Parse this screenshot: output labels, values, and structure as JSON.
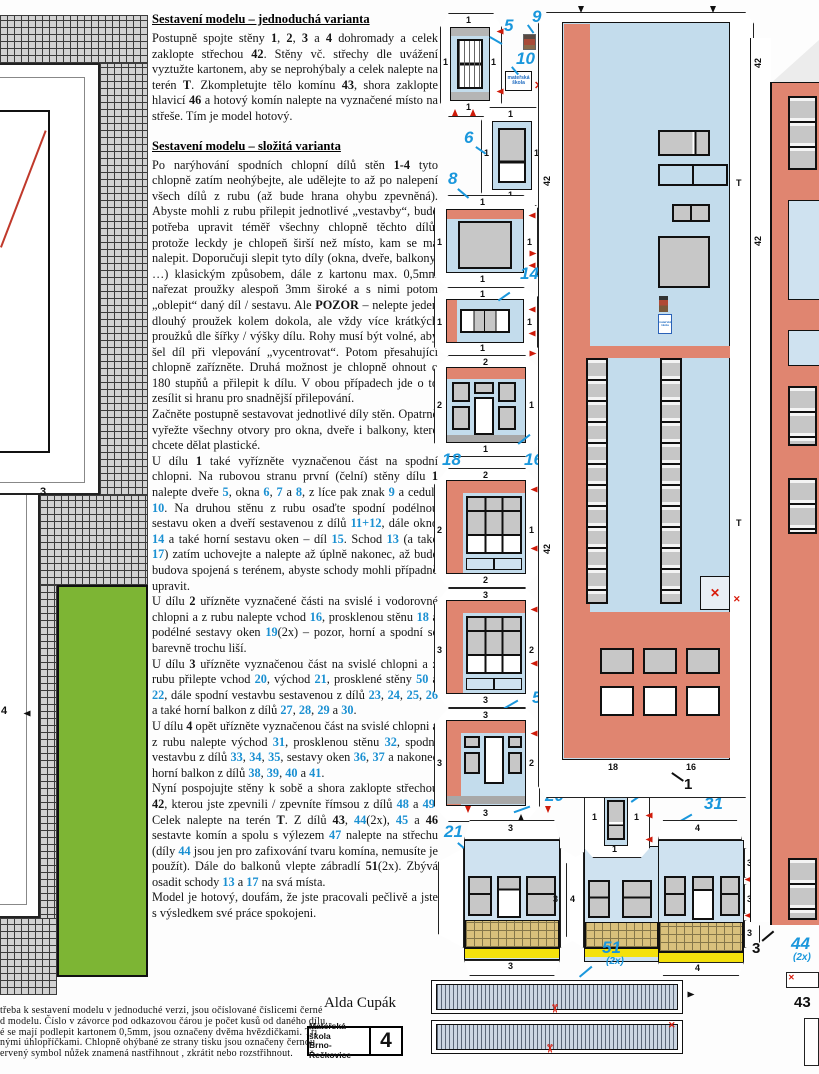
{
  "page": {
    "author": "Alda Cupák",
    "stamp": {
      "line1": "Mateřská škola",
      "line2": "Brno-Řečkovice",
      "number": "4"
    }
  },
  "instructions": {
    "heading_simple": "Sestavení modelu – jednoduchá varianta",
    "heading_complex": "Sestavení modelu – složitá varianta",
    "para_simple": [
      {
        "t": "Postupně spojte stěny "
      },
      {
        "t": "1",
        "c": "b"
      },
      {
        "t": ", "
      },
      {
        "t": "2",
        "c": "b"
      },
      {
        "t": ", "
      },
      {
        "t": "3",
        "c": "b"
      },
      {
        "t": " a "
      },
      {
        "t": "4",
        "c": "b"
      },
      {
        "t": " dohromady a celek zaklopte střechou "
      },
      {
        "t": "42",
        "c": "b"
      },
      {
        "t": ". Stěny vč. střechy dle uvážení vyztužte kartonem, aby se neprohýbaly a celek nalepte na terén "
      },
      {
        "t": "T",
        "c": "b"
      },
      {
        "t": ". Zkompletujte tělo komínu "
      },
      {
        "t": "43",
        "c": "b"
      },
      {
        "t": ", shora zaklopte hlavicí "
      },
      {
        "t": "46",
        "c": "b"
      },
      {
        "t": " a hotový komín nalepte na vyznačené místo na střeše. Tím je model hotový."
      }
    ],
    "paras_complex": [
      [
        {
          "t": "Po narýhování spodních chlopní dílů stěn "
        },
        {
          "t": "1-4",
          "c": "b"
        },
        {
          "t": " tyto chlopně zatím neohýbejte, ale udělejte to až po nalepení všech dílů z rubu (až bude hrana ohybu zpevněná). Abyste mohli z rubu přilepit jednotlivé „vestavby“, bude potřeba upravit téměř všechny chlopně těchto dílů, protože leckdy je chlopeň širší než místo, kam se má nalepit. Doporučuji slepit tyto díly (okna, dveře, balkony, …) klasickým způsobem, dále z kartonu max. 0,5mm nařezat proužky alespoň 3mm široké a s nimi potom „oblepit“ daný díl / sestavu. Ale "
        },
        {
          "t": "POZOR",
          "c": "b"
        },
        {
          "t": " – nelepte jeden dlouhý proužek kolem dokola, ale vždy více krátkých proužků dle šířky / výšky dílu. Rohy musí být volné, aby šel díl při vlepování „vycentrovat“. Potom přesahující chlopně zařízněte. Druhá možnost je chlopně ohnout o 180 stupňů a přilepit k dílu. V obou případech jde o to zesílit si hranu pro snadnější přilepování."
        }
      ],
      [
        {
          "t": "Začněte postupně sestavovat jednotlivé díly stěn. Opatrně vyřežte všechny otvory pro okna, dveře i balkony, které chcete dělat plastické."
        }
      ],
      [
        {
          "t": "U dílu "
        },
        {
          "t": "1",
          "c": "b"
        },
        {
          "t": " také vyřízněte vyznačenou část na spodní chlopni. Na rubovou stranu první (čelní) stěny dílu "
        },
        {
          "t": "1",
          "c": "b"
        },
        {
          "t": " nalepte dveře "
        },
        {
          "t": "5",
          "c": "n"
        },
        {
          "t": ", okna "
        },
        {
          "t": "6",
          "c": "n"
        },
        {
          "t": ", "
        },
        {
          "t": "7",
          "c": "n"
        },
        {
          "t": " a "
        },
        {
          "t": "8",
          "c": "n"
        },
        {
          "t": ", z líce pak znak "
        },
        {
          "t": "9",
          "c": "n"
        },
        {
          "t": " a ceduli "
        },
        {
          "t": "10",
          "c": "n"
        },
        {
          "t": ". Na druhou stěnu z rubu osaďte spodní podélnou sestavu oken a dveří sestavenou z dílů "
        },
        {
          "t": "11+12",
          "c": "n"
        },
        {
          "t": ", dále okno "
        },
        {
          "t": "14",
          "c": "n"
        },
        {
          "t": " a také horní sestavu oken – díl "
        },
        {
          "t": "15",
          "c": "n"
        },
        {
          "t": ". Schod "
        },
        {
          "t": "13",
          "c": "n"
        },
        {
          "t": " (a také "
        },
        {
          "t": "17",
          "c": "n"
        },
        {
          "t": ") zatím uchovejte a nalepte až úplně nakonec, až bude budova spojená s terénem, abyste schody mohli případně upravit."
        }
      ],
      [
        {
          "t": "U dílu "
        },
        {
          "t": "2",
          "c": "b"
        },
        {
          "t": " uřízněte vyznačené části na svislé i vodorovné chlopni a z rubu nalepte vchod "
        },
        {
          "t": "16",
          "c": "n"
        },
        {
          "t": ", prosklenou stěnu "
        },
        {
          "t": "18",
          "c": "n"
        },
        {
          "t": " a podélné sestavy oken "
        },
        {
          "t": "19",
          "c": "n"
        },
        {
          "t": "(2x) – pozor, horní a spodní se barevně trochu liší."
        }
      ],
      [
        {
          "t": "U dílu "
        },
        {
          "t": "3",
          "c": "b"
        },
        {
          "t": " uřízněte vyznačenou část na svislé chlopni a z rubu přilepte vchod "
        },
        {
          "t": "20",
          "c": "n"
        },
        {
          "t": ", východ "
        },
        {
          "t": "21",
          "c": "n"
        },
        {
          "t": ", prosklené stěny "
        },
        {
          "t": "50",
          "c": "n"
        },
        {
          "t": " a "
        },
        {
          "t": "22",
          "c": "n"
        },
        {
          "t": ", dále spodní vestavbu sestavenou z dílů "
        },
        {
          "t": "23",
          "c": "n"
        },
        {
          "t": ", "
        },
        {
          "t": "24",
          "c": "n"
        },
        {
          "t": ", "
        },
        {
          "t": "25",
          "c": "n"
        },
        {
          "t": ", "
        },
        {
          "t": "26",
          "c": "n"
        },
        {
          "t": " a také horní balkon z dílů "
        },
        {
          "t": "27",
          "c": "n"
        },
        {
          "t": ", "
        },
        {
          "t": "28",
          "c": "n"
        },
        {
          "t": ", "
        },
        {
          "t": "29",
          "c": "n"
        },
        {
          "t": " a "
        },
        {
          "t": "30",
          "c": "n"
        },
        {
          "t": "."
        }
      ],
      [
        {
          "t": "U dílu "
        },
        {
          "t": "4",
          "c": "b"
        },
        {
          "t": " opět uřízněte vyznačenou část na svislé chlopni a z rubu nalepte východ "
        },
        {
          "t": "31",
          "c": "n"
        },
        {
          "t": ", prosklenou stěnu "
        },
        {
          "t": "32",
          "c": "n"
        },
        {
          "t": ", spodní vestavbu z dílů "
        },
        {
          "t": "33",
          "c": "n"
        },
        {
          "t": ", "
        },
        {
          "t": "34",
          "c": "n"
        },
        {
          "t": ", "
        },
        {
          "t": "35",
          "c": "n"
        },
        {
          "t": ", sestavy oken "
        },
        {
          "t": "36",
          "c": "n"
        },
        {
          "t": ", "
        },
        {
          "t": "37",
          "c": "n"
        },
        {
          "t": " a nakonec horní balkon z dílů "
        },
        {
          "t": "38",
          "c": "n"
        },
        {
          "t": ", "
        },
        {
          "t": "39",
          "c": "n"
        },
        {
          "t": ", "
        },
        {
          "t": "40",
          "c": "n"
        },
        {
          "t": " a "
        },
        {
          "t": "41",
          "c": "n"
        },
        {
          "t": "."
        }
      ],
      [
        {
          "t": "Nyní pospojujte stěny k sobě a shora zaklopte střechou "
        },
        {
          "t": "42",
          "c": "b"
        },
        {
          "t": ", kterou jste zpevnili / zpevníte římsou z dílů "
        },
        {
          "t": "48",
          "c": "n"
        },
        {
          "t": " a "
        },
        {
          "t": "49",
          "c": "n"
        },
        {
          "t": ". Celek nalepte na terén "
        },
        {
          "t": "T",
          "c": "b"
        },
        {
          "t": ". Z dílů "
        },
        {
          "t": "43",
          "c": "b"
        },
        {
          "t": ", "
        },
        {
          "t": "44",
          "c": "n"
        },
        {
          "t": "(2x), "
        },
        {
          "t": "45",
          "c": "n"
        },
        {
          "t": " a "
        },
        {
          "t": "46",
          "c": "b"
        },
        {
          "t": " sestavte komín a spolu s výlezem "
        },
        {
          "t": "47",
          "c": "n"
        },
        {
          "t": " nalepte na střechu (díly "
        },
        {
          "t": "44",
          "c": "n"
        },
        {
          "t": " jsou jen pro zafixování tvaru komína, nemusíte je použít). Dále do balkonů vlepte zábradlí "
        },
        {
          "t": "51",
          "c": "b"
        },
        {
          "t": "(2x). Zbývá osadit schody "
        },
        {
          "t": "13",
          "c": "n"
        },
        {
          "t": " a "
        },
        {
          "t": "17",
          "c": "n"
        },
        {
          "t": " na svá místa."
        }
      ],
      [
        {
          "t": "Model je hotový, doufám, že jste pracovali pečlivě a jste s výsledkem své práce spokojeni."
        }
      ]
    ]
  },
  "footer": {
    "lines": [
      "třeba k sestavení modelu v jednoduché verzi, jsou očíslované číslicemi černé",
      "d modelu. Číslo v závorce pod odkazovou čárou je počet kusů od daného dílu.",
      "é se mají podlepit kartonem 0,5mm, jsou označeny dvěma hvězdičkami. Tři",
      "nými úhlopříčkami. Chlopně ohýbané ze strany tisku jsou označeny černou",
      "ervený symbol nůžek znamená nastřihnout , zkrátit nebo rozstřihnout."
    ]
  },
  "labels": {
    "n1": "1",
    "n3": "3",
    "n5": "5",
    "n6": "6",
    "n7": "7",
    "n8": "8",
    "n9": "9",
    "n10": "10",
    "n14": "14",
    "n16": "16",
    "n18": "18",
    "n20": "20",
    "n21": "21",
    "n31": "31",
    "n50": "50",
    "n51": "51",
    "n51x": "(2x)",
    "n44": "44",
    "n44x": "(2x)",
    "n43": "43"
  },
  "flaps": {
    "f1": "1",
    "f2": "2",
    "f3": "3",
    "f4": "4",
    "f42": "42",
    "fT": "T",
    "f16": "16",
    "f18": "18"
  },
  "marks": {
    "cut_x": "✕",
    "scissors": "✂"
  },
  "sign": {
    "line1": "mateřská",
    "line2": "škola"
  },
  "terrain": {
    "num3": "3",
    "num4": "4"
  },
  "colors": {
    "salmon": "#e08570",
    "light_blue": "#c3dcec",
    "glass_blue": "#cfe2f0",
    "pane_gray": "#c7c7c7",
    "grass_green": "#7db534",
    "tile_tan": "#d9c07c",
    "stripe_yellow": "#f4e10c",
    "label_blue": "#1a97dc",
    "marker_red": "#cf1b0a",
    "railing_blue": "#ccd6e2"
  }
}
